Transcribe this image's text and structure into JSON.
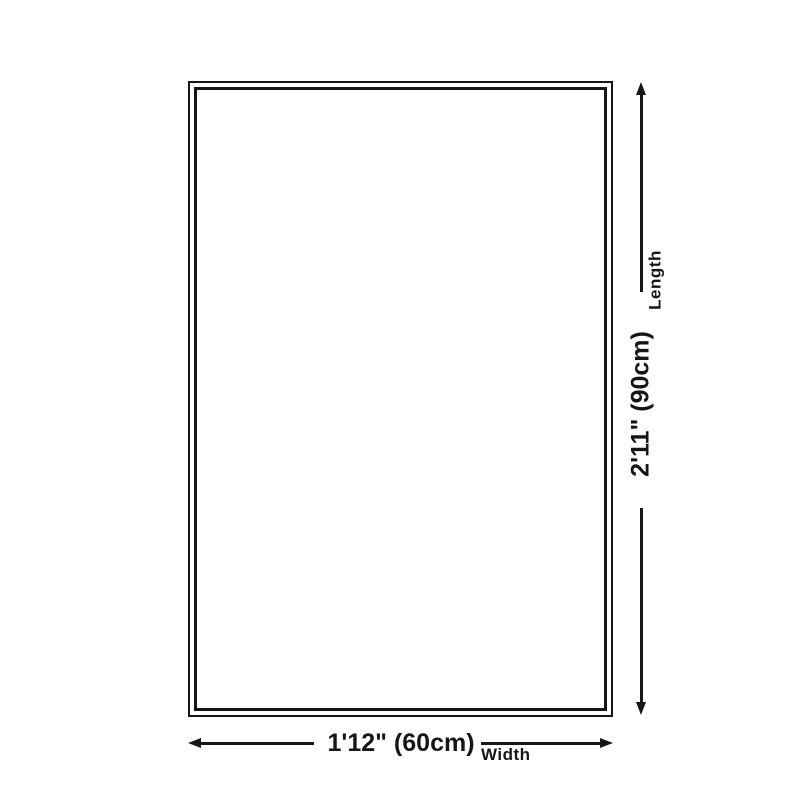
{
  "colors": {
    "ink": "#161616",
    "background": "#ffffff"
  },
  "diagram": {
    "length": {
      "value": "2'11\" (90cm)",
      "label": "Length"
    },
    "width": {
      "value": "1'12\" (60cm)",
      "label": "Width"
    }
  }
}
